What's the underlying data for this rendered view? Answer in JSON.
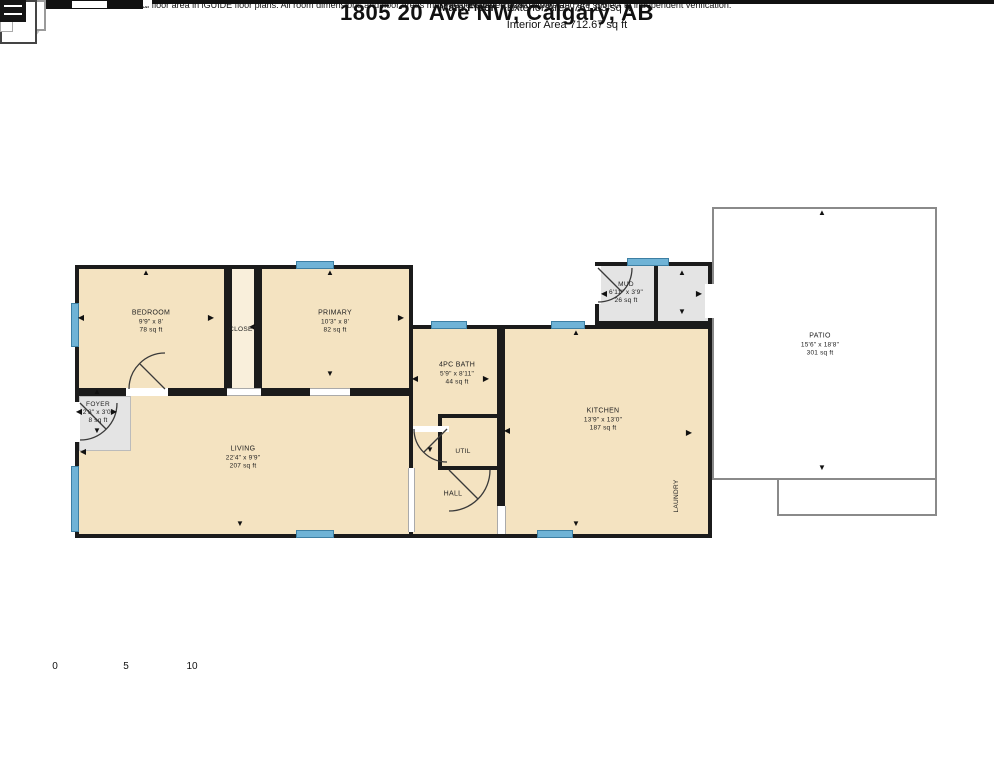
{
  "header": {
    "title": "1805 20 Ave NW, Calgary, AB",
    "floor_label": "Main Floor",
    "exterior_area": "Exterior Area 761.93 sq ft",
    "interior_area": "Interior Area 712.67 sq ft"
  },
  "rooms": {
    "bedroom": {
      "name": "BEDROOM",
      "dims": "9'9\" x 8'",
      "area": "78 sq ft"
    },
    "closet": {
      "name": "CLOSET"
    },
    "primary": {
      "name": "PRIMARY",
      "dims": "10'3\" x 8'",
      "area": "82 sq ft"
    },
    "bath": {
      "name": "4PC BATH",
      "dims": "5'9\" x 8'11\"",
      "area": "44 sq ft"
    },
    "mud": {
      "name": "MUD",
      "dims": "6'11\" x 3'9\"",
      "area": "26 sq ft"
    },
    "kitchen": {
      "name": "KITCHEN",
      "dims": "13'9\" x 13'0\"",
      "area": "187 sq ft"
    },
    "living": {
      "name": "LIVING",
      "dims": "22'4\" x 9'9\"",
      "area": "207 sq ft"
    },
    "foyer": {
      "name": "FOYER",
      "dims": "2'8\" x 3'0\"",
      "area": "8 sq ft"
    },
    "util": {
      "name": "UTIL"
    },
    "hall": {
      "name": "HALL"
    },
    "laundry": {
      "name": "LAUNDRY"
    },
    "patio": {
      "name": "PATIO",
      "dims": "15'6\" x 18'8\"",
      "area": "301 sq ft"
    }
  },
  "scale_bar": {
    "tick_0": "0",
    "tick_5": "5",
    "tick_10": "10",
    "unit": "ft"
  },
  "prepared": "PREPARED: 2025/11/06",
  "compass": {
    "north_label": "N"
  },
  "footer": {
    "disclaimer": "White regions are excluded from total floor area in iGUIDE floor plans. All room dimensions and floor areas must be considered approximate and are subject to independent verification."
  },
  "colors": {
    "room_fill": "#f4e3c1",
    "closet_fill": "#f9efdb",
    "gray_fill": "#e4e4e4",
    "window": "#6fb3d6",
    "wall": "#1b1b1b",
    "needle_red": "#c8281e",
    "compass_blue": "#c3def0"
  }
}
